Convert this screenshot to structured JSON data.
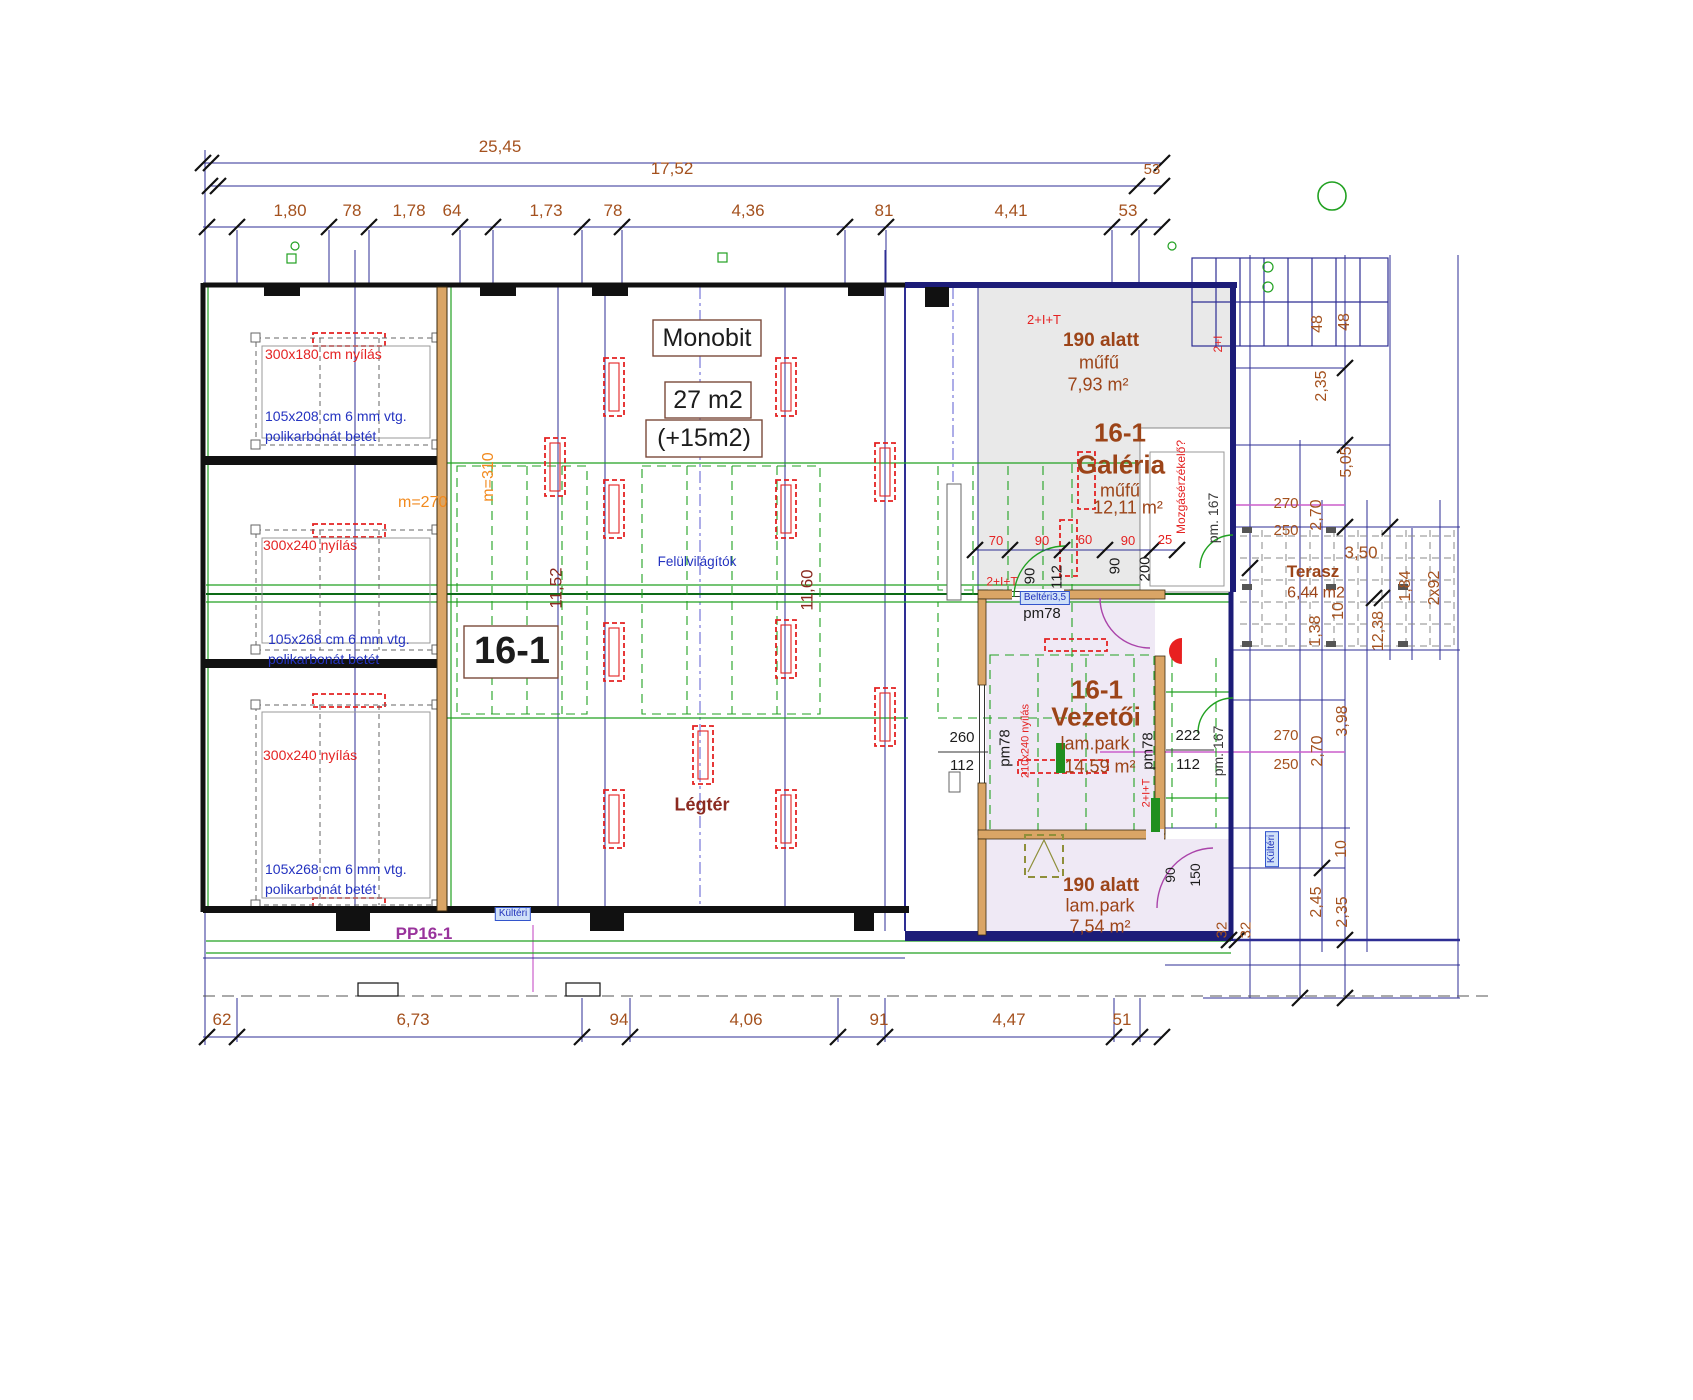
{
  "plan": {
    "top_dims": {
      "total": "25,45",
      "inner": "17,52",
      "end": "53",
      "segments": [
        "1,80",
        "78",
        "1,78",
        "64",
        "1,73",
        "78",
        "4,36",
        "81",
        "4,41",
        "53"
      ]
    },
    "bottom_dims": {
      "segments": [
        "62",
        "6,73",
        "94",
        "4,06",
        "91",
        "4,47",
        "51"
      ]
    },
    "left_bays": {
      "bay1_opening": "300x180 cm nyílás",
      "bay1_infill_line1": "105x208 cm 6 mm vtg.",
      "bay1_infill_line2": "polikarbonát betét",
      "bay2_opening": "300x240 nyílás",
      "bay2_infill_line1": "105x268 cm 6 mm vtg.",
      "bay2_infill_line2": "polikarbonát betét",
      "bay3_opening": "300x240 nyílás",
      "bay3_infill_line1": "105x268 cm 6 mm vtg.",
      "bay3_infill_line2": "polikarbonát betét",
      "partition": "PP16-1",
      "height1": "m=270",
      "height2": "m=310"
    },
    "hall": {
      "unit": "16-1",
      "name": "Monobit",
      "area_main": "27 m2",
      "area_extra": "(+15m2)",
      "skylights": "Felülvilágítók",
      "airspace": "Légtér",
      "width1": "11,52",
      "width2": "11,60",
      "outdoor_tag": "Kültéri"
    },
    "galeria": {
      "circuit": "2+I+T",
      "under": "190 alatt",
      "floor": "műfű",
      "area": "7,93 m²",
      "unit": "16-1",
      "name": "Galéria",
      "floor2": "műfű",
      "area2": "12,11 m²",
      "sensor": "Mozgásérzékelő?",
      "beam": "pm. 167",
      "circuit2": "2+I"
    },
    "door_dims": {
      "d70": "70",
      "d90a": "90",
      "d60": "60",
      "d90b": "90",
      "d25": "25",
      "v90a": "90",
      "v112": "112",
      "v90b": "90",
      "v200": "200",
      "circuit": "2+I+T",
      "door_tag": "Beltéri3,5",
      "lintel": "pm78"
    },
    "vezetoi": {
      "unit": "16-1",
      "name": "Vezetői",
      "floor": "lam.park",
      "area": "14,59 m²",
      "d260": "260",
      "d112": "112",
      "lintel": "pm78",
      "opening": "210x240 nyílás",
      "d222": "222",
      "d112b": "112",
      "lintel2": "pm78",
      "beam": "pm. 167",
      "circuit": "2+I+T"
    },
    "lower_room": {
      "under": "190 alatt",
      "floor": "lam.park",
      "area": "7,54 m²",
      "d90": "90",
      "d150": "150"
    },
    "terasz": {
      "name": "Terasz",
      "area": "6,44 m2"
    },
    "right_dims": {
      "d48a": "48",
      "d48b": "48",
      "d235a": "2,35",
      "d505": "5,05",
      "d270a": "270",
      "d250a": "250",
      "d270v_a": "2,70",
      "d350": "3,50",
      "d184": "1,84",
      "d2x92": "2x92",
      "d10a": "10",
      "d138": "1,38",
      "d1238": "12,38",
      "d398": "3,98",
      "d270b": "270",
      "d250b": "250",
      "d270v_b": "2,70",
      "d10b": "10",
      "d245": "2,45",
      "d235b": "2,35",
      "d32a": "32",
      "d32b": "32",
      "outdoor_tag": "Kültéri"
    }
  }
}
